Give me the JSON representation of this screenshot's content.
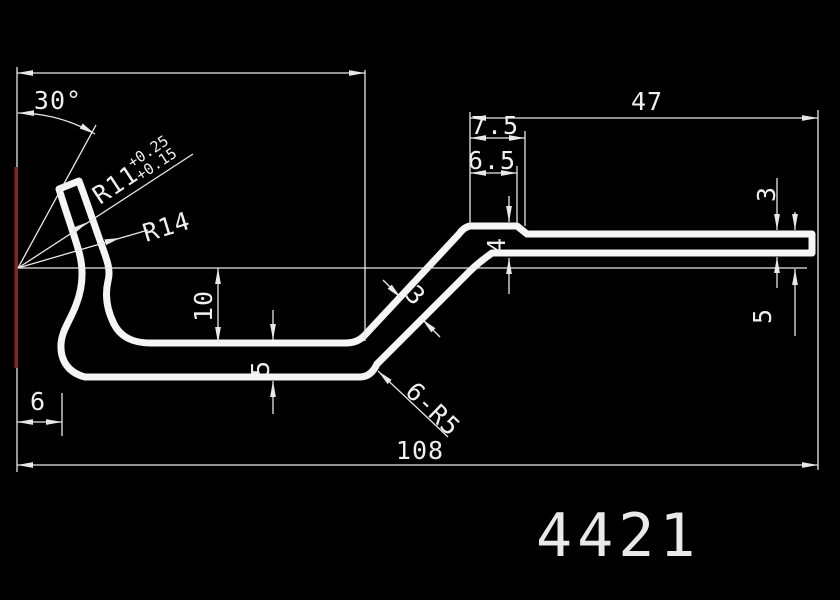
{
  "drawing": {
    "part_number": "4421",
    "colors": {
      "background": "#000000",
      "lines": "#efefef",
      "datum_red": "#8f1f1f"
    },
    "dimensions": {
      "angle_label": "30°",
      "radius_small": "R11",
      "radius_small_tol_upper": "+0.25",
      "radius_small_tol_lower": "+0.15",
      "radius_large": "R14",
      "hook_depth": "10",
      "channel_wall_thickness": "5",
      "hook_offset": "6",
      "overall_length": "108",
      "right_flat_length": "47",
      "step_length_outer": "7.5",
      "step_length_inner": "6.5",
      "mid_section_thickness": "4",
      "slant_thickness": "3",
      "tip_thickness": "3",
      "tip_height": "5",
      "bend_note": "6-R5"
    }
  }
}
